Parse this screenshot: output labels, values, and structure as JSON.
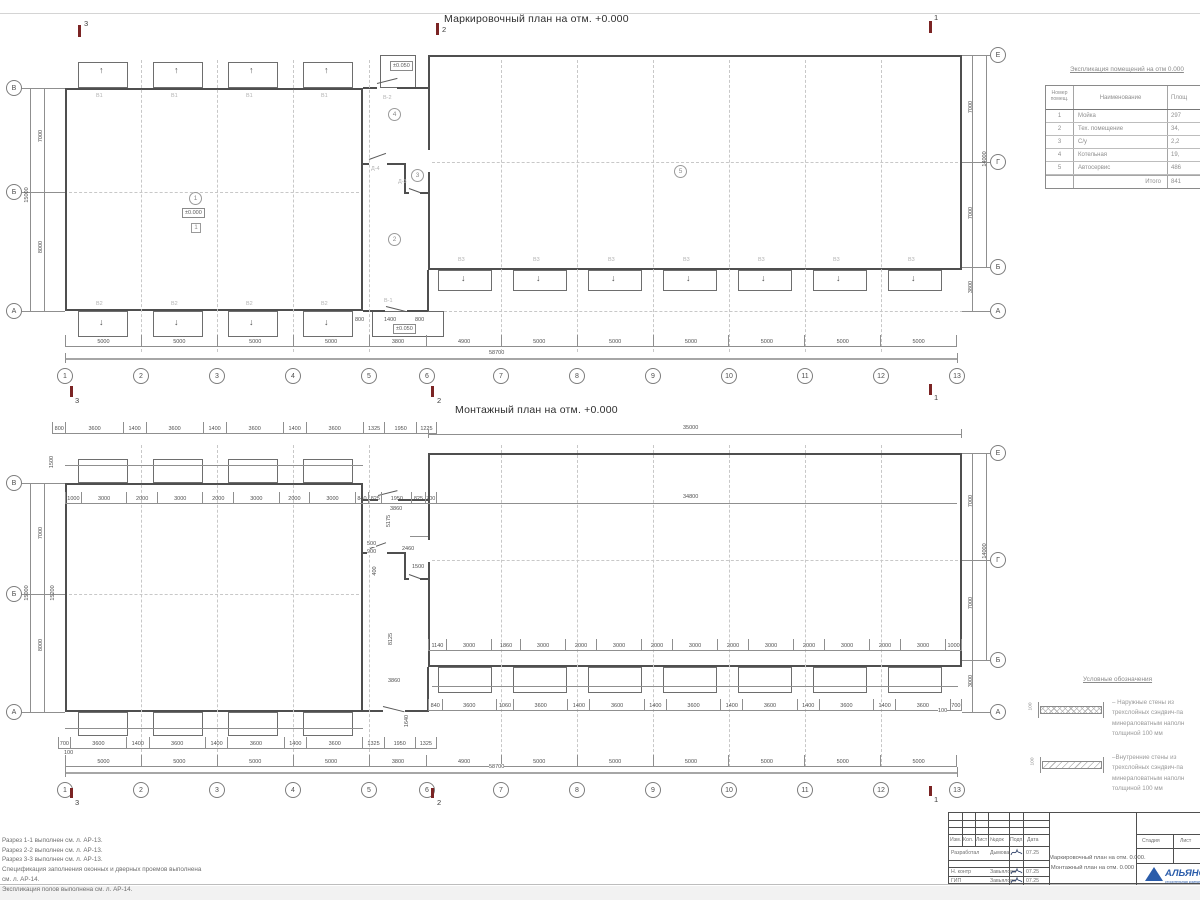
{
  "titles": {
    "top_plan": "Маркировочный план на отм. +0.000",
    "bottom_plan": "Монтажный план на отм. +0.000"
  },
  "icons": {
    "arrow_up": "↑",
    "arrow_down": "↓"
  },
  "columns": [
    "1",
    "2",
    "3",
    "4",
    "5",
    "6",
    "7",
    "8",
    "9",
    "10",
    "11",
    "12",
    "13"
  ],
  "section_marks": {
    "s1": "1",
    "s2": "2",
    "s3": "3"
  },
  "top_plan": {
    "axis_dims": [
      "5000",
      "5000",
      "5000",
      "5000",
      "3800",
      "4900",
      "5000",
      "5000",
      "5000",
      "5000",
      "5000",
      "5000"
    ],
    "total_dim": "58700",
    "left_axes": [
      "В",
      "Б",
      "А"
    ],
    "left_dims": [
      "7000",
      "8000",
      "15000"
    ],
    "right_axes": [
      "Е",
      "Г",
      "Б",
      "А"
    ],
    "right_dims": [
      "7000",
      "7000",
      "14000",
      "3800"
    ],
    "rooms": {
      "r1": "1",
      "r2": "2",
      "r3": "3",
      "r4": "4",
      "r5": "5"
    },
    "floor_tag": "1",
    "elev_main": "±0.000",
    "elev_small": "±0.050",
    "tags": {
      "win_top": "В1",
      "win_bottom": "В2",
      "win_right": "В3",
      "door_top": "В-2",
      "door_bottom": "В-1",
      "door_d3": "Д-3",
      "door_d4": "Д-4"
    },
    "small_dims": [
      "800",
      "1400",
      "800"
    ]
  },
  "bottom_plan": {
    "axis_dims": [
      "5000",
      "5000",
      "5000",
      "5000",
      "3800",
      "4900",
      "5000",
      "5000",
      "5000",
      "5000",
      "5000",
      "5000"
    ],
    "total_dim": "58700",
    "left_axes": [
      "В",
      "Б",
      "А"
    ],
    "right_axes": [
      "Е",
      "Г",
      "Б",
      "А"
    ],
    "top_row1": [
      "800",
      "3600",
      "1400",
      "3600",
      "1400",
      "3600",
      "1400",
      "3600",
      "1325",
      "1950",
      "1225"
    ],
    "top_row2": [
      "1000",
      "3000",
      "2000",
      "3000",
      "2000",
      "3000",
      "2000",
      "3000",
      "840",
      "825",
      "1950",
      "825",
      "700"
    ],
    "right_top_dim": "35000",
    "right_inner_dim": "34800",
    "right_bottom_row1": [
      "1140",
      "3000",
      "1860",
      "3000",
      "2000",
      "3000",
      "2000",
      "3000",
      "2000",
      "3000",
      "2000",
      "3000",
      "2000",
      "3000",
      "1000"
    ],
    "right_bottom_row2": [
      "840",
      "3600",
      "1060",
      "3600",
      "1400",
      "3600",
      "1400",
      "3600",
      "1400",
      "3600",
      "1400",
      "3600",
      "1400",
      "3600",
      "700"
    ],
    "bottom_row1": [
      "700",
      "3600",
      "1400",
      "3600",
      "1400",
      "3600",
      "1400",
      "3600",
      "1325",
      "1950",
      "1325"
    ],
    "left_dims": [
      "1500",
      "7000",
      "8000",
      "15000",
      "15200"
    ],
    "right_dims": [
      "7000",
      "7000",
      "14000",
      "3000"
    ],
    "small_100": "100",
    "mid_dims": [
      "3860",
      "5175",
      "500",
      "900",
      "2460",
      "1500",
      "400",
      "8125",
      "3860",
      "1640"
    ]
  },
  "room_table": {
    "title": "Экспликация помещений на отм 0.000",
    "headers": {
      "num": "Номер помещ.",
      "name": "Наименование",
      "area": "Площ"
    },
    "rows": [
      {
        "num": "1",
        "name": "Мойка",
        "area": "297"
      },
      {
        "num": "2",
        "name": "Тех. помещение",
        "area": "34,"
      },
      {
        "num": "3",
        "name": "С/у",
        "area": "2,2"
      },
      {
        "num": "4",
        "name": "Котельная",
        "area": "19,"
      },
      {
        "num": "5",
        "name": "Автосервис",
        "area": "486"
      }
    ],
    "total_label": "Итого",
    "total_value": "841"
  },
  "legend": {
    "title": "Условные обозначения",
    "items": [
      {
        "thickness": "100",
        "l1": "– Наружные стены из",
        "l2": "трехслойных сэндвич-па",
        "l3": "минераловатным наполн",
        "l4": "толщиной 100 мм"
      },
      {
        "thickness": "100",
        "l1": "–Внутренние стены из",
        "l2": "трехслойных сэндвич-па",
        "l3": "минераловатным наполн",
        "l4": "толщиной 100 мм"
      }
    ]
  },
  "notes": [
    "Разрез 1-1 выполнен см. л. АР-13.",
    "Разрез 2-2 выполнен см. л. АР-13.",
    "Разрез 3-3 выполнен см. л. АР-13.",
    "Спецификация заполнения оконных и дверных проемов выполнена",
    "см. л. АР-14.",
    "Экспликация полов выполнена см. л. АР-14."
  ],
  "title_block": {
    "cols": [
      "Изм.",
      "Кол.",
      "Лист",
      "№док",
      "Подп.",
      "Дата"
    ],
    "rows": [
      {
        "role": "Разработал",
        "name": "Дымова",
        "date": "07.25"
      },
      {
        "role": "Н. контр",
        "name": "Завьялова",
        "date": "07.25"
      },
      {
        "role": "ГИП",
        "name": "Завьялова",
        "date": "07.25"
      }
    ],
    "doc_title_line1": "Маркировочный план на отм. 0.000.",
    "doc_title_line2": "Монтажный план на отм. 0.000",
    "stage_label": "Стадия",
    "sheet_label": "Лист",
    "company": "АЛЬЯНС",
    "company_sub": "строительная компания"
  },
  "colors": {
    "accent_blue": "#2a5caa",
    "line": "#4f4f4f",
    "dim_text": "#4f4f4f",
    "tag_text": "#b3b3b3",
    "section_mark": "#7b2424"
  }
}
